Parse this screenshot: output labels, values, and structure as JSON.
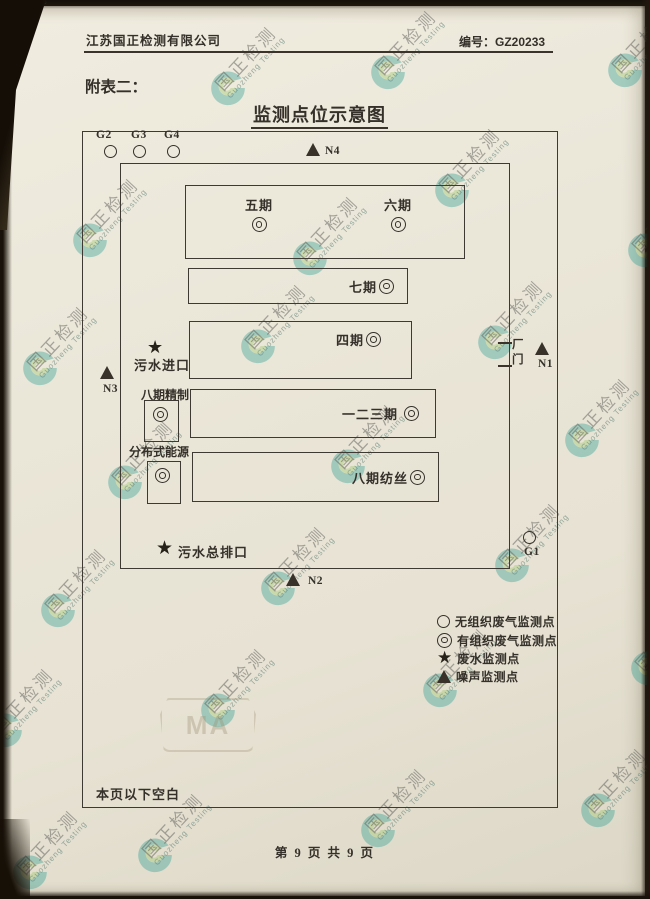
{
  "watermark": {
    "cn": "国正检测",
    "en": "Guozheng Testing",
    "cma": "MA"
  },
  "header": {
    "company": "江苏国正检测有限公司",
    "doc_no_label": "编号：",
    "doc_no": "GZ20233"
  },
  "attachment_label": "附表二：",
  "diagram": {
    "title": "监测点位示意图",
    "points": {
      "G1": "G1",
      "G2": "G2",
      "G3": "G3",
      "G4": "G4",
      "N1": "N1",
      "N2": "N2",
      "N3": "N3",
      "N4": "N4"
    },
    "buildings": {
      "phase5": "五期",
      "phase6": "六期",
      "phase7": "七期",
      "phase4": "四期",
      "phase123": "一二三期",
      "phase8_spinning": "八期纺丝",
      "phase8_refining": "八期精制",
      "distributed_energy": "分布式能源"
    },
    "marks": {
      "sewage_inlet": "污水进口",
      "sewage_main_outlet": "污水总排口",
      "gate_top": "厂",
      "gate_bottom": "门"
    }
  },
  "legend": {
    "items": [
      {
        "symbol": "open-circle",
        "label": "无组织废气监测点"
      },
      {
        "symbol": "double-circle",
        "label": "有组织废气监测点"
      },
      {
        "symbol": "star",
        "label": "废水监测点"
      },
      {
        "symbol": "triangle",
        "label": "噪声监测点"
      }
    ]
  },
  "blank_note": "本页以下空白",
  "footer": {
    "page_text": "第 9 页 共 9 页"
  },
  "colors": {
    "paper": "#e9e4d6",
    "ink": "#35302a",
    "logo_teal": "#2e9e92",
    "logo_green": "#9cc968",
    "watermark_gray": "#6f6f6a"
  }
}
